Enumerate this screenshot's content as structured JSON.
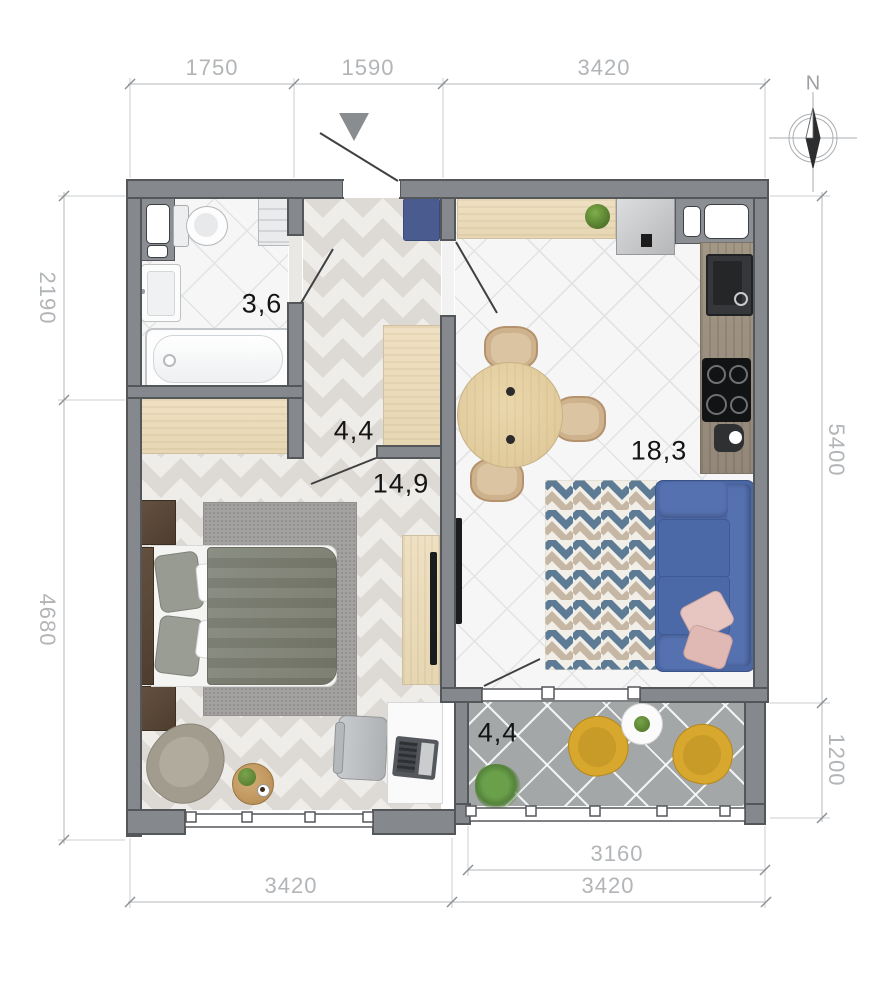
{
  "compass": {
    "north_label": "N"
  },
  "rooms": {
    "bathroom": {
      "area": "3,6"
    },
    "hallway": {
      "area": "4,4"
    },
    "bedroom": {
      "area": "14,9"
    },
    "kitchen_living": {
      "area": "18,3"
    },
    "balcony": {
      "area": "4,4"
    }
  },
  "dimensions": {
    "top": [
      "1750",
      "1590",
      "3420"
    ],
    "left": [
      "2190",
      "4680"
    ],
    "right": [
      "5400",
      "1200"
    ],
    "bottom": [
      "3420",
      "3160",
      "3420"
    ]
  },
  "colors": {
    "wall": "#85888c",
    "sofa": "#4a66a3",
    "accent_chair": "#d7a72e",
    "rug_blue": "#5d7b95",
    "rug_tan": "#c6b6a4",
    "entry_mat": "#4a5b90",
    "pillow_pink": "#e7c6c2",
    "floor_wood": "#efede9",
    "floor_tile": "#f6f6f7",
    "balcony_floor": "#a4a7a8",
    "dimension_text": "#b2b5b8",
    "label_text": "#141414"
  }
}
